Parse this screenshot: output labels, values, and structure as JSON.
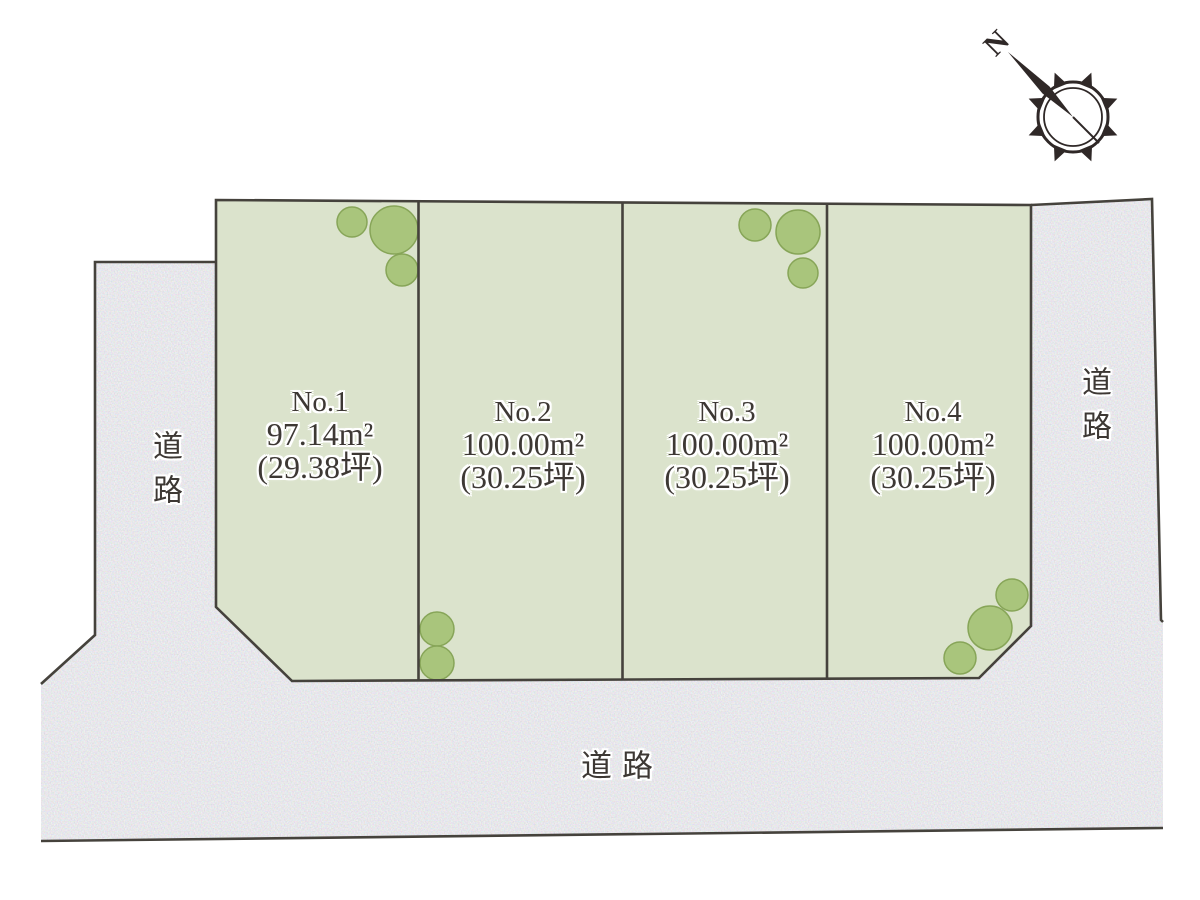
{
  "compass": {
    "north_label": "N"
  },
  "lots": [
    {
      "name": "No.1",
      "area_m2": "97.14m²",
      "area_tsubo": "(29.38坪)"
    },
    {
      "name": "No.2",
      "area_m2": "100.00m²",
      "area_tsubo": "(30.25坪)"
    },
    {
      "name": "No.3",
      "area_m2": "100.00m²",
      "area_tsubo": "(30.25坪)"
    },
    {
      "name": "No.4",
      "area_m2": "100.00m²",
      "area_tsubo": "(30.25坪)"
    }
  ],
  "roads": {
    "left_label": "道路",
    "right_label": "道路",
    "bottom_label": "道路"
  },
  "colors": {
    "lot_fill": "#dbe3cc",
    "road_fill": "#d9d9dc",
    "outline": "#45423c",
    "tree_fill": "#a9c57c",
    "tree_stroke": "#87a558",
    "text": "#3d3834",
    "compass": "#2f2827"
  }
}
